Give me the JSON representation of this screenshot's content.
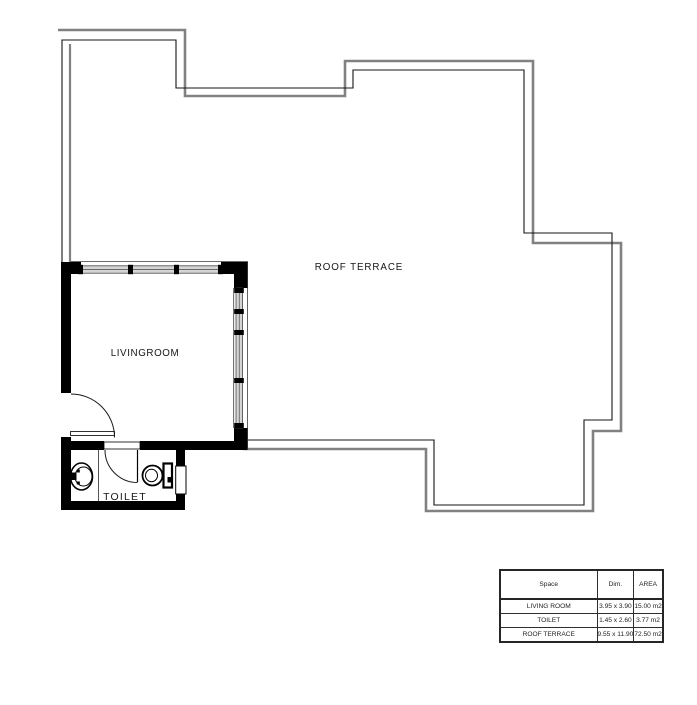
{
  "plan": {
    "labels": {
      "roof_terrace": "ROOF TERRACE",
      "livingroom": "LIVINGROOM",
      "toilet": "TOILET"
    },
    "colors": {
      "wall_fill": "#000000",
      "parapet_outer": "#818181",
      "parapet_inner": "#141414",
      "window_fill": "#d4d4d4"
    }
  },
  "area_table": {
    "headers": {
      "space": "Space",
      "dim": "Dim.",
      "area": "AREA"
    },
    "rows": [
      {
        "space": "LIVING ROOM",
        "dim": "3.95 x 3.90",
        "area": "15.00 m2"
      },
      {
        "space": "TOILET",
        "dim": "1.45 x 2.60",
        "area": "3.77 m2"
      },
      {
        "space": "ROOF TERRACE",
        "dim": "9.55 x 11.90",
        "area": "72.50 m2"
      }
    ]
  }
}
